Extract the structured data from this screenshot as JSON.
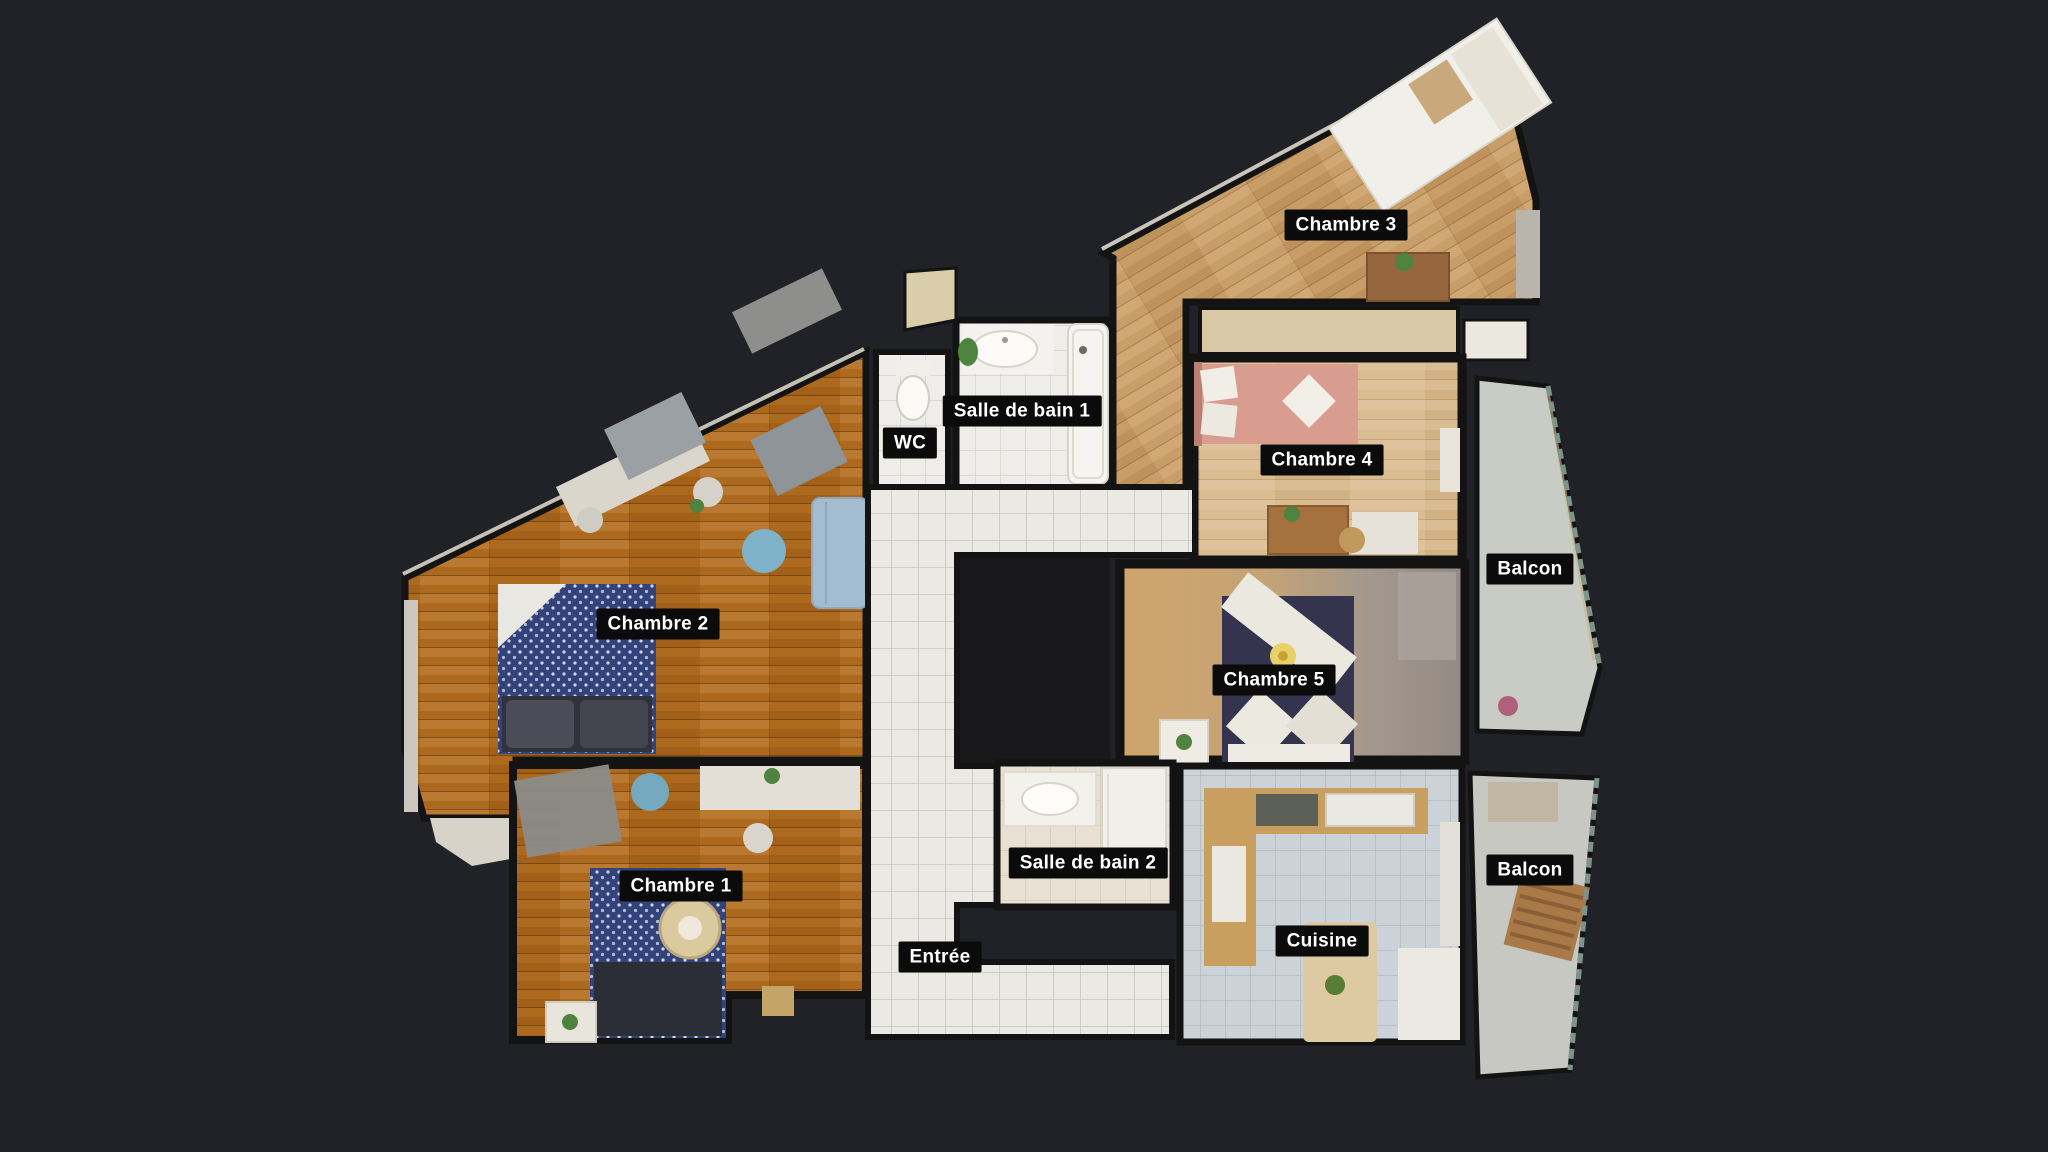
{
  "background_color": "#212227",
  "label_style": {
    "background": "#0b0b0b",
    "text_color": "#ffffff"
  },
  "palette": {
    "wall": "#131313",
    "wood_warm": "#ad6a1f",
    "wood_light": "#c99d68",
    "wood_pale": "#d9bc92",
    "tile_white": "#ebe9e4",
    "tile_bath": "#eeede9",
    "tile_beige": "#e8e1d3",
    "tile_kitchen_blue": "#ccd3d8",
    "balcony_gray": "#c9ccc5",
    "bed_navy": "#32427a",
    "bed_dark_navy": "#34344e",
    "bed_pink": "#d99d8f"
  },
  "rooms": {
    "chambre1": {
      "label": "Chambre 1"
    },
    "chambre2": {
      "label": "Chambre 2"
    },
    "chambre3": {
      "label": "Chambre 3"
    },
    "chambre4": {
      "label": "Chambre 4"
    },
    "chambre5": {
      "label": "Chambre 5"
    },
    "salle_de_bain_1": {
      "label": "Salle de bain 1"
    },
    "salle_de_bain_2": {
      "label": "Salle de bain 2"
    },
    "wc": {
      "label": "WC"
    },
    "balcon_nord": {
      "label": "Balcon"
    },
    "balcon_sud": {
      "label": "Balcon"
    },
    "cuisine": {
      "label": "Cuisine"
    },
    "entree": {
      "label": "Entrée"
    }
  }
}
